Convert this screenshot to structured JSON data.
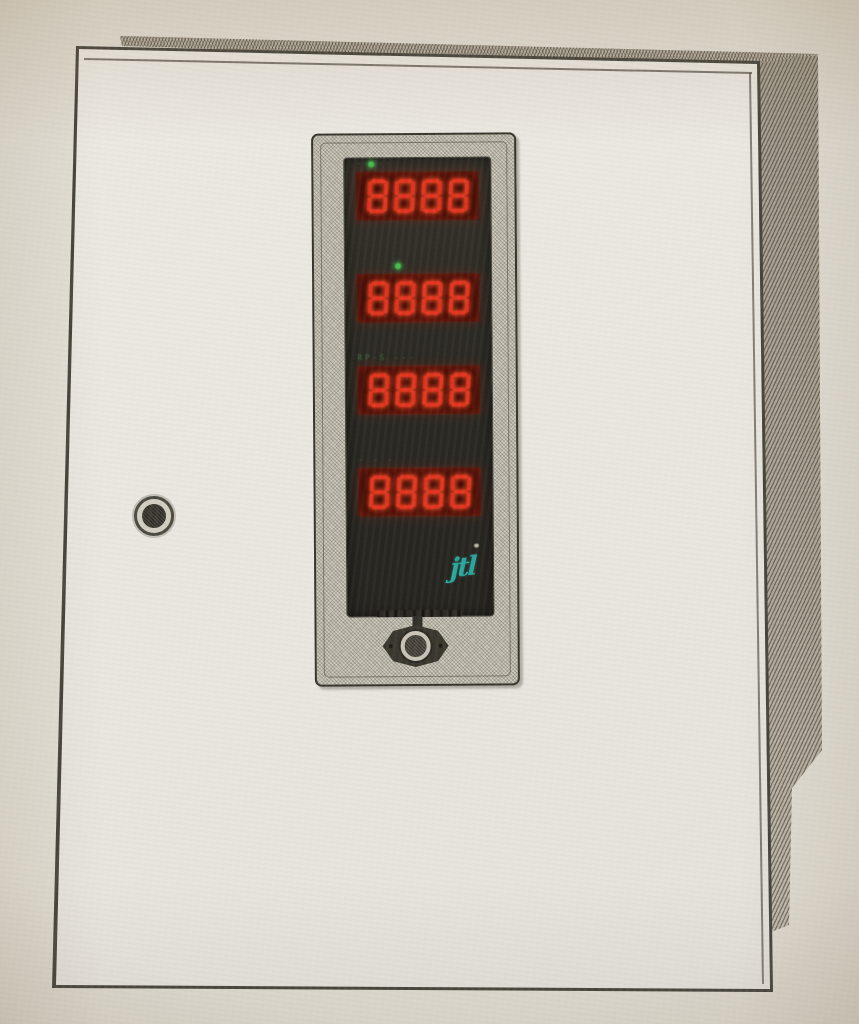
{
  "scene": {
    "alt_text": "Photograph of a light beige wall-mounted control cabinet with a vertical LED display module on the door",
    "paper_color": "#e0dcd2",
    "cabinet_color": "#e9e6df",
    "outline_color": "#45433b",
    "hatch_color": "#a49d8f"
  },
  "display_panel": {
    "bezel_color": "#cfcbbe",
    "face_color": "#2b2923",
    "window_bg": "#380d06",
    "digit_color": "#e2351f",
    "label_color": "#48a152",
    "logo": {
      "text": "jtl",
      "color": "#2aa69c"
    },
    "rows": [
      {
        "value": "8888",
        "label": "·····",
        "led_dot": true,
        "led_x": 24
      },
      {
        "value": "8888",
        "label": "",
        "led_dot": true,
        "led_x": 50
      },
      {
        "value": "8888",
        "label": "RP-S ---",
        "led_dot": false,
        "led_x": 0
      },
      {
        "value": "8888",
        "label": "- - -",
        "led_dot": false,
        "led_x": 0
      }
    ]
  },
  "hardware": {
    "door_lock_icon": "keyhole-icon",
    "panel_latch_icon": "latch-icon"
  }
}
